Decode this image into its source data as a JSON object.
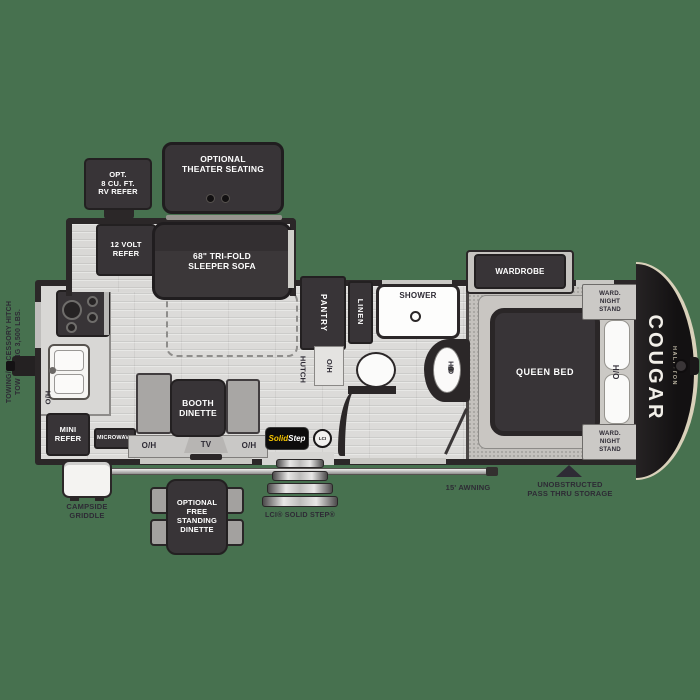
{
  "meta": {
    "drawing": "travel trailer floor plan",
    "brand": "COUGAR",
    "brand_sub": "HALF-TON"
  },
  "colors": {
    "background": "#47714f",
    "walls": "#2b2728",
    "furniture_dark": "#383437",
    "floor": "#dcdbd9",
    "carpet": "#c4c1bd",
    "annotation_text": "#2e2b35",
    "badge_yellow": "#f6c500",
    "cap_trim": "#d9d1ba"
  },
  "labels": {
    "opt_refer": "OPT.\n8 CU. FT.\nRV REFER",
    "theater": "OPTIONAL\nTHEATER SEATING",
    "volt_refer": "12 VOLT\nREFER",
    "sofa": "68\" TRI-FOLD\nSLEEPER SOFA",
    "pantry": "PANTRY",
    "linen": "LINEN",
    "shower": "SHOWER",
    "hutch": "HUTCH",
    "oh": "O/H",
    "wardrobe": "WARDROBE",
    "nightstand": "WARD.\nNIGHT\nSTAND",
    "queen_bed": "QUEEN BED",
    "mini_refer": "MINI\nREFER",
    "microwave": "MICROWAVE",
    "booth_dinette": "BOOTH\nDINETTE",
    "tv": "TV",
    "optional_dinette": "OPTIONAL\nFREE\nSTANDING\nDINETTE",
    "steps": "LCI® SOLID STEP®",
    "awning": "15' AWNING",
    "passthru": "UNOBSTRUCTED\nPASS THRU STORAGE",
    "griddle": "CAMPSIDE\nGRIDDLE",
    "towing": "TOWING/ACCESSORY HITCH\nTOW RATING 3,500 LBS.",
    "brand": "COUGAR",
    "brand_sub": "HALF-TON",
    "badge_solid": "Solid",
    "badge_step": "Step",
    "badge_lci": "LCI"
  }
}
